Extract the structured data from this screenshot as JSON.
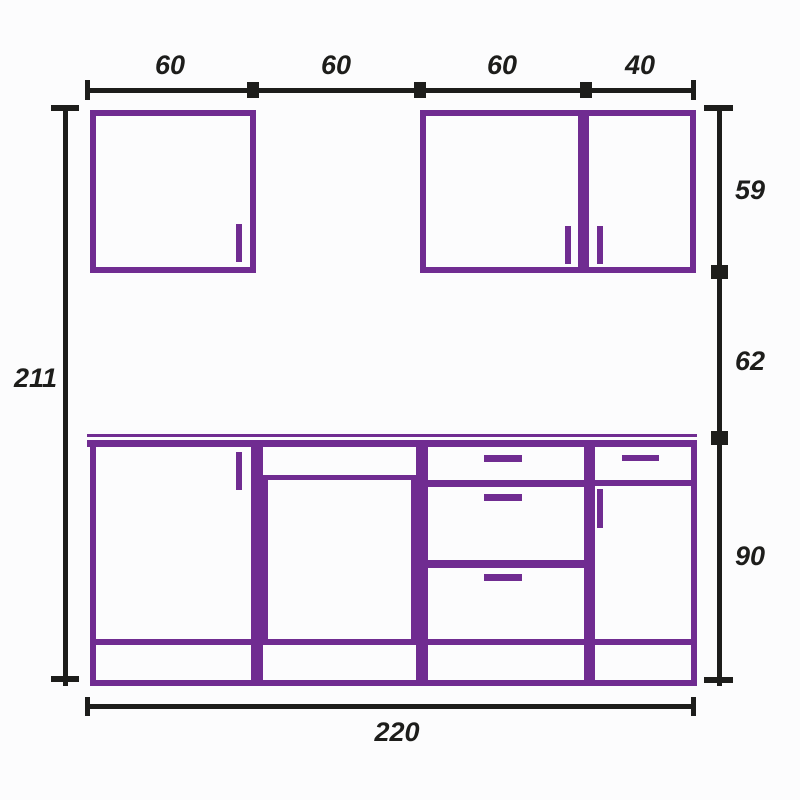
{
  "drawing": {
    "subject": "kitchen-cabinet-elevation",
    "colors": {
      "cabinet": "#702c91",
      "dimension": "#1d1d1b",
      "background": "#fcfcfd"
    },
    "top_dims": {
      "seg1": "60",
      "seg2": "60",
      "seg3": "60",
      "seg4": "40"
    },
    "left_dims": {
      "total_height": "211"
    },
    "right_dims": {
      "upper_height": "59",
      "gap_height": "62",
      "base_height": "90"
    },
    "bottom_dims": {
      "total_width": "220"
    }
  }
}
